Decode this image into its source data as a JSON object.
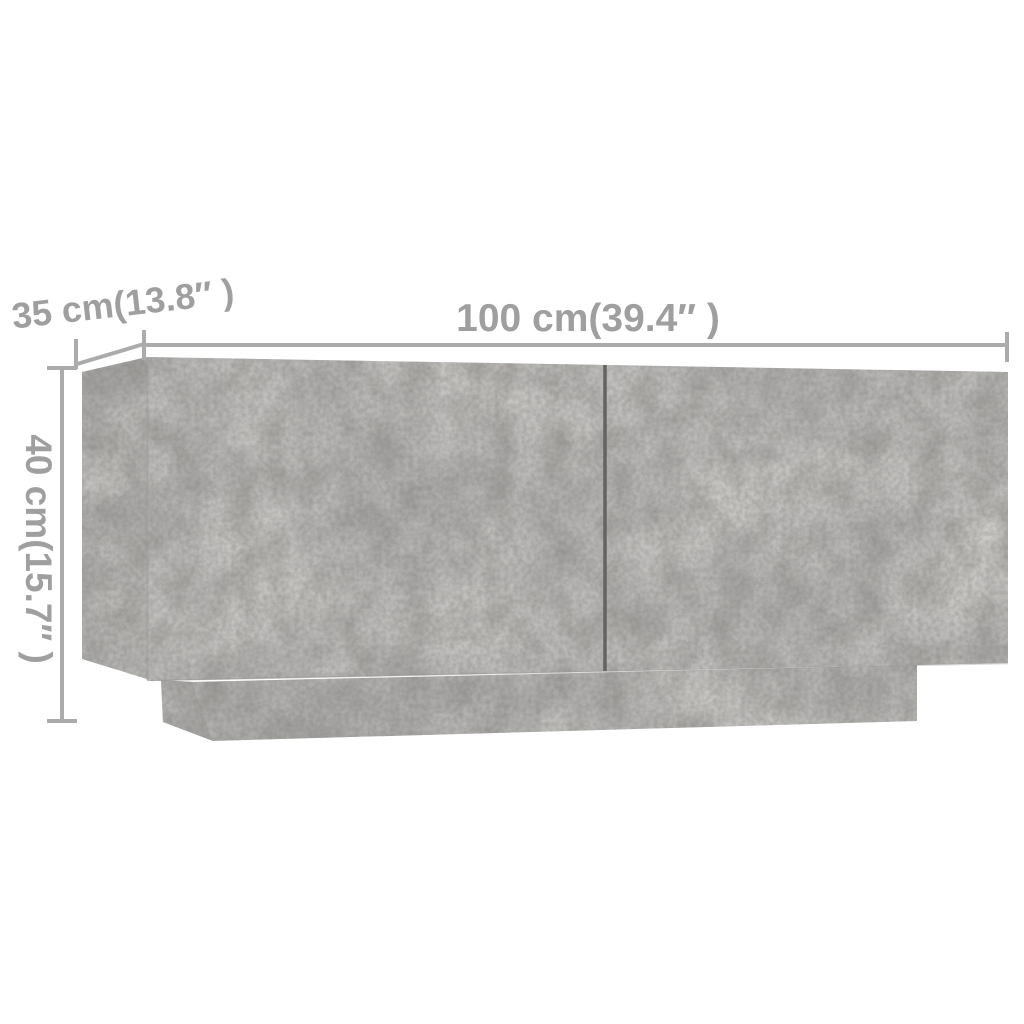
{
  "page": {
    "background_color": "#ffffff"
  },
  "furniture": {
    "description": "concrete grey cabinet with two front doors and recessed plinth base, shown in three-quarter perspective",
    "colors": {
      "front_face": "#b4b3b1",
      "side_panel": "#a7a6a4",
      "plinth_front": "#b0afad",
      "plinth_side": "#9c9b99",
      "door_gap": "#636361",
      "edge_seam": "#9b9a98",
      "door_bottom_shadow": "#8f8e8c"
    }
  },
  "dimensions": {
    "line_color": "#ababab",
    "text_color": "#9f9f9f",
    "width": {
      "label": "100 cm(39.4″ )",
      "cm": 100,
      "inch": 39.4
    },
    "depth": {
      "label": "35 cm(13.8″ )",
      "cm": 35,
      "inch": 13.8
    },
    "height": {
      "label": "40 cm(15.7″ )",
      "cm": 40,
      "inch": 15.7
    }
  }
}
